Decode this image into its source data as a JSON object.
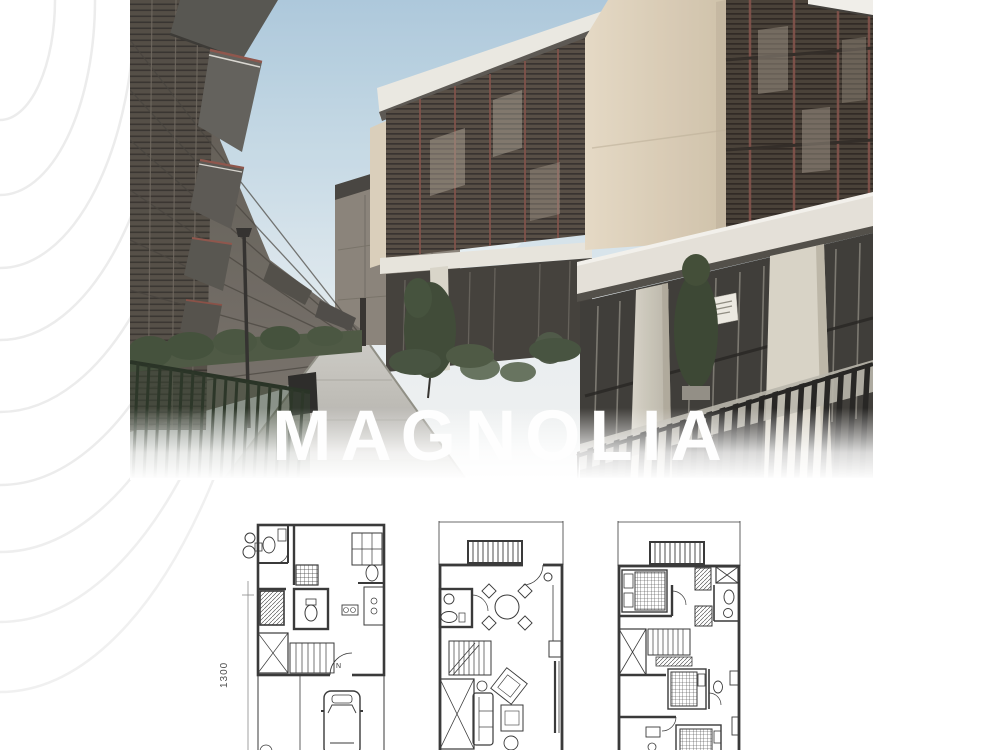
{
  "hero": {
    "title": "MAGNOLIA",
    "title_color": "#fefefe"
  },
  "floor_plans": {
    "dimension_label": "1300",
    "north_label": "N",
    "plans": [
      {
        "id": "ground-floor-plan"
      },
      {
        "id": "second-floor-plan"
      },
      {
        "id": "third-floor-plan"
      }
    ]
  },
  "palette": {
    "page_background": "#ffffff",
    "contour_line": "#ececec",
    "sky": "#aecade",
    "cream_wall": "#dccfb8",
    "louver_dark": "#4a443c",
    "louver_frame_red": "#7c4a42",
    "fence_green": "#222d1e",
    "fence_black": "#1d1c1a",
    "plan_line": "#3a3a3a"
  }
}
